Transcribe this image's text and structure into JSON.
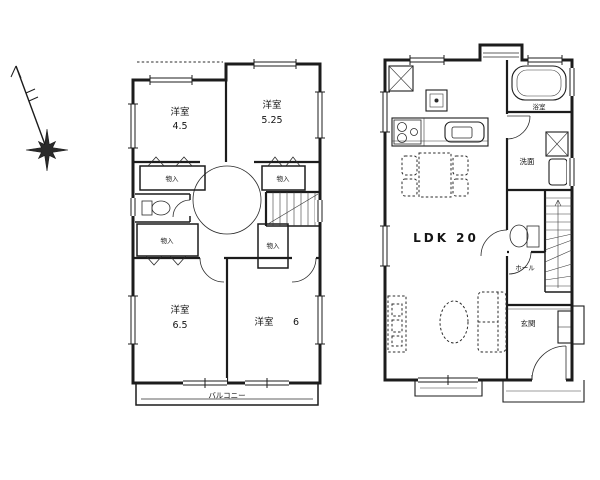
{
  "colors": {
    "line": "#1c1c1c",
    "background": "#ffffff"
  },
  "compass": {
    "icon": "compass-north-arrow"
  },
  "floor2": {
    "rooms": [
      {
        "name": "洋室",
        "size": "4.5"
      },
      {
        "name": "洋室",
        "size": "5.25"
      },
      {
        "name": "洋室",
        "size": "6.5"
      },
      {
        "name": "洋室",
        "size": "6"
      }
    ],
    "closet_labels": [
      "物入",
      "物入",
      "物入",
      "物入"
    ],
    "balcony": "バルコニー"
  },
  "floor1": {
    "ldk": "LDK 20",
    "bath": "浴室",
    "washroom": "洗面",
    "hall": "ホール",
    "entrance": "玄関"
  }
}
